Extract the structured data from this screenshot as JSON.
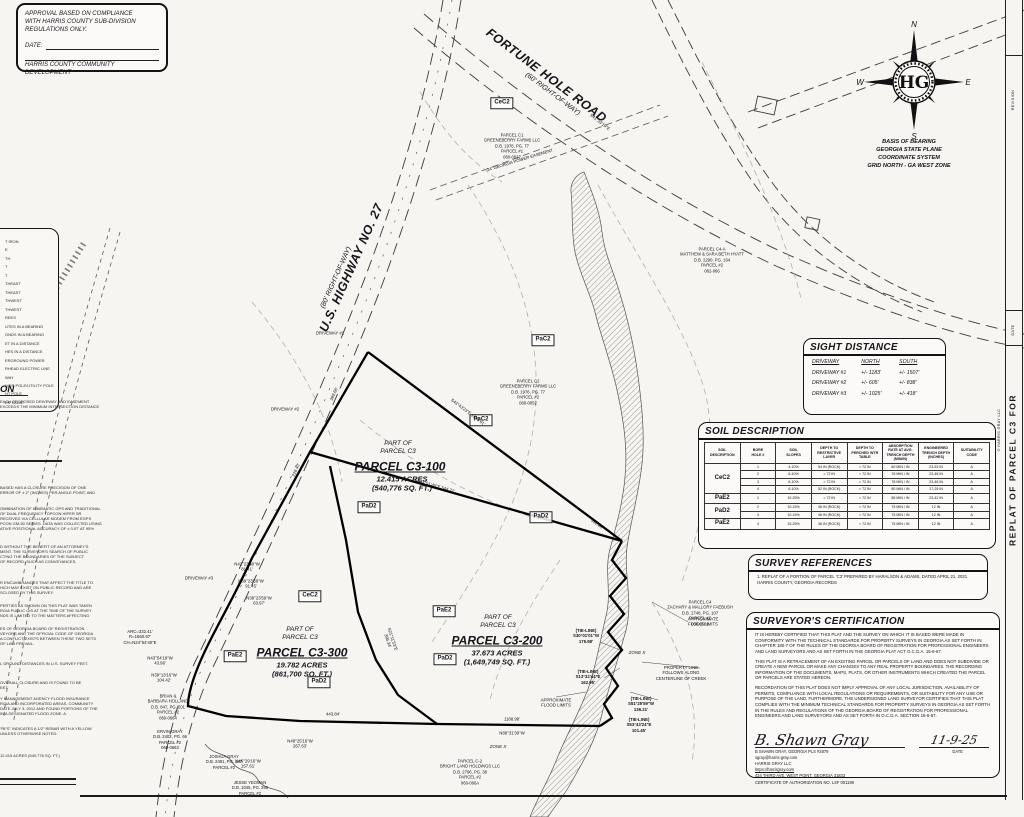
{
  "approval": {
    "line1": "APPROVAL BASED ON COMPLIANCE",
    "line2": "WITH HARRIS COUNTY SUB-DIVISION",
    "line3": "REGULATIONS ONLY.",
    "date_label": "DATE:",
    "agency": "HARRIS COUNTY COMMUNITY DEVELOPMENT"
  },
  "compass": {
    "n": "N",
    "e": "E",
    "s": "S",
    "w": "W",
    "monogram": "HG"
  },
  "basis": {
    "text": "BASIS OF BEARING\nGEORGIA STATE PLANE\nCOORDINATE SYSTEM\nGRID NORTH - GA WEST ZONE"
  },
  "sight_distance": {
    "title": "SIGHT DISTANCE",
    "headers": [
      "DRIVEWAY",
      "NORTH",
      "SOUTH"
    ],
    "rows": [
      [
        "DRIVEWAY #1",
        "+/- 1183'",
        "+/- 1507'"
      ],
      [
        "DRIVEWAY #2",
        "+/- 605'",
        "+/- 838'"
      ],
      [
        "DRIVEWAY #3",
        "+/- 1025'",
        "+/- 418'"
      ]
    ]
  },
  "soil_table": {
    "title": "SOIL DESCRIPTION",
    "headers": [
      "SOIL\nDESCRIPTION",
      "BORE\nHOLE #",
      "SOIL\nSLOPES",
      "DEPTH TO\nRESTRICTIVE\nLAYER",
      "DEPTH TO\nPERCHED WTR\nTABLE",
      "ABSORPTION\nRATE AT AVG.\nTRENCH DEPTH\n(MIN/IN)",
      "ENGINEERED\nTRENCH DEPTH\n(INCHES)",
      "SUITABILITY\nCODE"
    ],
    "groups": [
      {
        "code": "CeC2"
      },
      {
        "code": "PaE2"
      },
      {
        "code": "PaD2"
      },
      {
        "code": "PaE2"
      }
    ],
    "rows": [
      [
        "1",
        "4-10%",
        "54 IN (ROCK)",
        "> 72 IN",
        "80 MIN / IN",
        "23-53 IN",
        "A"
      ],
      [
        "2",
        "6-10%",
        "> 72 IN",
        "> 72 IN",
        "78 MIN / IN",
        "23-48 IN",
        "A"
      ],
      [
        "3",
        "6-10%",
        "> 72 IN",
        "> 72 IN",
        "78 MIN / IN",
        "23-48 IN",
        "A"
      ],
      [
        "4",
        "6-10%",
        "52 IN (ROCK)",
        "> 72 IN",
        "80 MIN / IN",
        "17-25 IN",
        "A"
      ],
      [
        "1",
        "10-25%",
        "> 72 IN",
        "> 72 IN",
        "85 MIN / IN",
        "23-42 IN",
        "A"
      ],
      [
        "2",
        "10-15%",
        "36 IN (ROCK)",
        "> 72 IN",
        "75 MIN / IN",
        "12 IN",
        "A"
      ],
      [
        "3",
        "10-15%",
        "36 IN (ROCK)",
        "> 72 IN",
        "75 MIN / IN",
        "12 IN",
        "A"
      ],
      [
        "4",
        "15-25%",
        "36 IN (ROCK)",
        "> 72 IN",
        "75 MIN / IN",
        "12 IN",
        "A"
      ]
    ]
  },
  "survey_references": {
    "title": "SURVEY REFERENCES",
    "item": "1.   REPLAT OF A PORTION OF PARCEL 'C3' PREPARED BY HARALSON & ADAMS, DATED APRIL 21, 2021 HARRIS COUNTY, GEORGIA RECORDS"
  },
  "cert": {
    "title": "SURVEYOR'S CERTIFICATION",
    "p1": "IT IS HEREBY CERTIFIED THAT THIS PLAT AND THE SURVEY ON WHICH IT IS BASED WERE MADE IN CONFORMITY WITH THE TECHNICAL STANDARDS FOR PROPERTY SURVEYS IN GEORGIA AS SET FORTH IN CHAPTER 180-7 OF THE RULES OF THE GEORGIA BOARD OF REGISTRATION FOR PROFESSIONAL ENGINEERS AND LAND SURVEYORS AND AS SET FORTH IN THE GEORGIA PLAT ACT O.C.G.A. 15-6-67.",
    "p2": "THIS PLAT IS A RETRACEMENT OF AN EXISTING PARCEL OR PARCELS OF LAND AND DOES NOT SUBDIVIDE OR CREATE A NEW PARCEL OR MAKE ANY CHANGES TO ANY REAL PROPERTY BOUNDARIES. THE RECORDING INFORMATION OF THE DOCUMENTS, MAPS, PLATS, OR OTHER INSTRUMENTS WHICH CREATED THE PARCEL OR PARCELS ARE STATED HEREON.",
    "p3": "RECORDATION OF THIS PLAT DOES NOT IMPLY APPROVAL OF ANY LOCAL JURISDICTION, AVAILABILITY OF PERMITS, COMPLIANCE WITH LOCAL REGULATIONS OR REQUIREMENTS, OR SUITABILITY FOR ANY USE OR PURPOSE OF THE LAND. FURTHERMORE, THE UNDERSIGNED LAND SURVEYOR CERTIFIES THAT THIS PLAT COMPLIES WITH THE MINIMUM TECHNICAL STANDARDS FOR PROPERTY SURVEYS IN GEORGIA AS SET FORTH IN THE RULES AND REGULATIONS OF THE GEORGIA BOARD OF REGISTRATION FOR PROFESSIONAL ENGINEERS AND LAND SURVEYORS AND AS SET FORTH IN O.C.G.A. SECTION 15-6-67.",
    "sig_script": "B. Shawn Gray",
    "name_line": "B SHAWN GRAY,  GEORGIA PLS #2879",
    "date_script": "11-9-25",
    "date_label": "DATE",
    "email": "sgray@harris-gray.com",
    "firm": "HARRIS GRAY LLC",
    "url": "https://harrisgray.com",
    "addr": "424 THIRD AVE, WEST POINT, GEORGIA 31833",
    "cert_no": "CERTIFICATE OF AUTHORIZATION NO. LSF 001199"
  },
  "left_margin": {
    "legend": [
      "T IRON",
      "E",
      "TH",
      "T",
      "T",
      "THEAST",
      "THEAST",
      "THWEST",
      "THWEST",
      "REES",
      "UTES IN A BEARING",
      "ONDS IN A BEARING",
      "ET IN A DISTANCE",
      "HES IN A DISTANCE",
      "ERGROUND POWER",
      "RHEAD ELECTRIC LINE",
      "WAY",
      "WER POLE/UTILITY POLE",
      "HT POLE",
      "ER VALVE"
    ],
    "driveway_header": "ON",
    "a": [
      "EACH PROPOSED DRIVEWAY AND EASEMENT",
      "EXCEEDS THE MINIMUM INTERSECTION DISTANCE"
    ],
    "b": [
      "BASED HAS A CLOSURE PRECISION OF ONE",
      "ERROR OF ± 2\" (INCHES) PER ANGLE POINT, AND"
    ],
    "c": [
      "OMBINATION OF KINEMATIC GPS AND TRADITIONAL",
      "OF DUAL FREQUENCY TOPCON HIPER SR",
      "RECEIVED VIA CELLULAR MODEM FROM EGPS",
      "PCON GM-50 SERIES. DATA WAS COLLECTED USING",
      "ATIVE POSITIONAL ACCURACY OF ± 0.07' AT 95%"
    ],
    "d": [
      "D WITHOUT THE BENEFIT OF AN ATTORNEY'S",
      "MENT. THE SURVEYOR'S SEARCH OF PUBLIC",
      "CTING THE BOUNDARIES OF THE SUBJECT",
      "OF RECORD, SUCH AS CONVEYANCES,"
    ],
    "e": [
      "R ENCUMBRANCES THAT AFFECT THE TITLE TO",
      "HICH MAY EXIST ON PUBLIC RECORD AND ARE",
      "SCLOSED BY THIS SURVEY."
    ],
    "f": [
      "PERTIES AS SHOWN ON THIS PLAT WAS TAKEN",
      "RGIA PUBLIC GIS AT THE TIME OF THE SURVEY",
      "NDS IS LIMITED TO THE MATTERS AFFECTING"
    ],
    "g": [
      "ES OF GEORGIA BOARD OF REGISTRATION",
      "VEYORS AND THE OFFICIAL CODE OF GEORGIA",
      "A CONFLICT EXISTS BETWEEN THESE TWO SETS",
      "OF LAW PREVAIL."
    ],
    "h": [
      "L GROUND DISTANCES IN U.S. SURVEY FEET."
    ],
    "i": [
      "OVERALL CLOSURE AND IS FOUND TO BE",
      "EET."
    ],
    "j": [
      "Y MANAGEMENT AGENCY FLOOD INSURANCE",
      "RGIA AND INCORPORATED AREAS, COMMUNITY",
      "DATE JULY 3, 2012 AND FOUND PORTIONS OF THE",
      "IN A DESIGNATED FLOOD ZONE. A"
    ],
    "k": [
      "\"RFS\" INDICATES A 1/2\" REBAR WITH A YELLOW",
      "UNLESS OTHERWISE NOTED."
    ],
    "l": [
      "12.415 ACRES (540,776 SQ. FT.)"
    ]
  },
  "map": {
    "labels": [
      {
        "t": "FORTUNE HOLE ROAD",
        "x": 546,
        "y": 76,
        "r": 37,
        "c": "rd"
      },
      {
        "t": "(60' RIGHT-OF-WAY)",
        "x": 552,
        "y": 95,
        "r": 37,
        "c": "rd2"
      },
      {
        "t": "U.S. HIGHWAY NO. 27",
        "x": 352,
        "y": 268,
        "r": -66,
        "c": "rd"
      },
      {
        "t": "(80' RIGHT-OF-WAY)",
        "x": 337,
        "y": 278,
        "r": -66,
        "c": "rd2"
      },
      {
        "t": "PART OF\nPARCEL C3",
        "x": 398,
        "y": 448,
        "r": 0,
        "c": "pio"
      },
      {
        "t": "PARCEL C3-100",
        "x": 400,
        "y": 467,
        "r": 0,
        "c": "pname"
      },
      {
        "t": "12.415 ACRES\n(540,776 SQ. FT.)",
        "x": 402,
        "y": 484,
        "r": 0,
        "c": "parea"
      },
      {
        "t": "PART OF\nPARCEL C3",
        "x": 300,
        "y": 634,
        "r": 0,
        "c": "pio"
      },
      {
        "t": "PARCEL C3-300",
        "x": 302,
        "y": 653,
        "r": 0,
        "c": "pname"
      },
      {
        "t": "19.782 ACRES\n(861,700 SQ. FT.)",
        "x": 302,
        "y": 670,
        "r": 0,
        "c": "parea"
      },
      {
        "t": "PART OF\nPARCEL C3",
        "x": 498,
        "y": 622,
        "r": 0,
        "c": "pio"
      },
      {
        "t": "PARCEL C3-200",
        "x": 497,
        "y": 641,
        "r": 0,
        "c": "pname"
      },
      {
        "t": "37.673 ACRES\n(1,649,749 SQ. FT.)",
        "x": 497,
        "y": 658,
        "r": 0,
        "c": "parea"
      },
      {
        "t": "PARCEL C1\nGREENEBERRY FARMS LLC\nD.B. 1976, PG. 77\nPARCEL #1\n060-0027",
        "x": 512,
        "y": 146,
        "r": 0,
        "c": "own"
      },
      {
        "t": "PARCEL C2\nGREENEBERRY FARMS LLC\nD.B. 1976, PG. 77\nPARCEL #2\n060-0052",
        "x": 528,
        "y": 392,
        "r": 0,
        "c": "own"
      },
      {
        "t": "PARCEL C4-A\nMATTHEW & SARA BETH HYATT\nD.B. 2290, PG. 164\nPARCEL #2\n062-066",
        "x": 712,
        "y": 260,
        "r": 0,
        "c": "own"
      },
      {
        "t": "PARCEL C4\nZACHARY & MALLORY FAEBUSH\nD.B. 2748, PG. 107\nPARCEL #2\n060-0561",
        "x": 700,
        "y": 613,
        "r": 0,
        "c": "own"
      },
      {
        "t": "PARCEL C-2\nBRIGHT LAND HOLDINGS LLC\nD.B. 2796, PG. 38\nPARCEL #2\n060-066A",
        "x": 470,
        "y": 772,
        "r": 0,
        "c": "own"
      },
      {
        "t": "BRIAN &\nBARBARA HOLLAND\nD.B. 847, PG. 201\nPARCEL #2\n060-0664",
        "x": 168,
        "y": 707,
        "r": 0,
        "c": "own"
      },
      {
        "t": "ERVIN GRAY\nD.B. 2402, PG. 66\nPARCEL #2\n060-0663",
        "x": 170,
        "y": 740,
        "r": 0,
        "c": "own"
      },
      {
        "t": "JOSHUA GRAY\nD.B. 2491, PG. 187\nPARCEL #2",
        "x": 224,
        "y": 762,
        "r": 0,
        "c": "own"
      },
      {
        "t": "JESSE YEOMAN\nD.B. 1045, PG. 295\nPARCEL #2",
        "x": 250,
        "y": 788,
        "r": 0,
        "c": "own"
      },
      {
        "t": "CeC2",
        "x": 502,
        "y": 103,
        "r": 0,
        "c": "soil"
      },
      {
        "t": "PaC2",
        "x": 543,
        "y": 340,
        "r": 0,
        "c": "soil"
      },
      {
        "t": "PaC2",
        "x": 481,
        "y": 420,
        "r": 0,
        "c": "soil"
      },
      {
        "t": "PaD2",
        "x": 369,
        "y": 507,
        "r": 0,
        "c": "soil"
      },
      {
        "t": "PaD2",
        "x": 541,
        "y": 517,
        "r": 0,
        "c": "soil"
      },
      {
        "t": "PaE2",
        "x": 444,
        "y": 611,
        "r": 0,
        "c": "soil"
      },
      {
        "t": "PaD2",
        "x": 445,
        "y": 659,
        "r": 0,
        "c": "soil"
      },
      {
        "t": "CeC2",
        "x": 310,
        "y": 596,
        "r": 0,
        "c": "soil"
      },
      {
        "t": "PaE2",
        "x": 235,
        "y": 656,
        "r": 0,
        "c": "soil"
      },
      {
        "t": "PaD2",
        "x": 319,
        "y": 682,
        "r": 0,
        "c": "soil"
      },
      {
        "t": "S43°43'23\"E  1398.81'",
        "x": 468,
        "y": 412,
        "r": 37,
        "c": "bear"
      },
      {
        "t": "532.46'",
        "x": 597,
        "y": 524,
        "r": 37,
        "c": "bear"
      },
      {
        "t": "S44°51'45\"E  544.21'",
        "x": 436,
        "y": 486,
        "r": 16,
        "c": "bear"
      },
      {
        "t": "S21°11'53\"E\n396.34'",
        "x": 390,
        "y": 640,
        "r": 72,
        "c": "bear"
      },
      {
        "t": "1188.98'",
        "x": 512,
        "y": 719,
        "r": 0,
        "c": "bear"
      },
      {
        "t": "N89°31'30\"W",
        "x": 512,
        "y": 733,
        "r": 0,
        "c": "bear"
      },
      {
        "t": "443.84'",
        "x": 333,
        "y": 714,
        "r": 0,
        "c": "bear"
      },
      {
        "t": "N48°25'16\"W\n267.63'",
        "x": 300,
        "y": 744,
        "r": 0,
        "c": "bear"
      },
      {
        "t": "N46°29'16\"W\n157.61'",
        "x": 248,
        "y": 764,
        "r": 0,
        "c": "bear"
      },
      {
        "t": "N42°23'10\"W\n81.41'",
        "x": 247,
        "y": 567,
        "r": 0,
        "c": "bear"
      },
      {
        "t": "N39°23'59\"W\n91.45'",
        "x": 251,
        "y": 584,
        "r": 0,
        "c": "bear"
      },
      {
        "t": "N39°23'59\"W\n63.97'",
        "x": 259,
        "y": 601,
        "r": 0,
        "c": "bear"
      },
      {
        "t": "ARC=332.41'\nR=1660.97'\nCH=N24°54'40\"E",
        "x": 140,
        "y": 637,
        "r": 0,
        "c": "bear"
      },
      {
        "t": "N43°54'19\"W\n43.96'",
        "x": 160,
        "y": 661,
        "r": 0,
        "c": "bear"
      },
      {
        "t": "N39°13'16\"W\n104.42'",
        "x": 164,
        "y": 678,
        "r": 0,
        "c": "bear"
      },
      {
        "t": "(TIE-LINE)\nS30°01'01\"W\n175.98'",
        "x": 586,
        "y": 636,
        "r": 0,
        "c": "bear bd"
      },
      {
        "t": "(TIE-LINE)\nS13°32'44\"E\n162.95'",
        "x": 588,
        "y": 677,
        "r": 0,
        "c": "bear bd"
      },
      {
        "t": "(TIE-LINE)\nS51°25'59\"W\n136.21'",
        "x": 641,
        "y": 704,
        "r": 0,
        "c": "bear bd"
      },
      {
        "t": "(TIE-LINE)\nS53°43'24\"E\n101.45'",
        "x": 639,
        "y": 725,
        "r": 0,
        "c": "bear bd"
      },
      {
        "t": "DRIVEWAY #1",
        "x": 330,
        "y": 333,
        "r": 0,
        "c": "tinyl"
      },
      {
        "t": "DRIVEWAY #2",
        "x": 285,
        "y": 409,
        "r": 0,
        "c": "tinyl"
      },
      {
        "t": "DRIVEWAY #3",
        "x": 199,
        "y": 578,
        "r": 0,
        "c": "tinyl"
      },
      {
        "t": "24' GEORGIA POWER EASEMENT",
        "x": 520,
        "y": 160,
        "r": -17,
        "c": "tinyl"
      },
      {
        "t": "S41°33'19\"E",
        "x": 600,
        "y": 122,
        "r": 38,
        "c": "bear"
      },
      {
        "t": "399.66'",
        "x": 334,
        "y": 394,
        "r": -66,
        "c": "bear"
      },
      {
        "t": "228.43'",
        "x": 296,
        "y": 470,
        "r": -66,
        "c": "bear"
      },
      {
        "t": "ZONE X",
        "x": 637,
        "y": 653,
        "r": 0,
        "c": "zone"
      },
      {
        "t": "ZONE X",
        "x": 498,
        "y": 747,
        "r": 0,
        "c": "zone"
      },
      {
        "t": "APPROXIMATE\nFLOOD LIMITS",
        "x": 556,
        "y": 703,
        "r": 0,
        "c": "tinyl"
      },
      {
        "t": "APPROXIMATE\nFLOOD LIMITS",
        "x": 703,
        "y": 622,
        "r": 0,
        "c": "tinyl"
      },
      {
        "t": "PROPERTY LINE\nFOLLOWS ALONG\nCENTERLINE OF CREEK",
        "x": 681,
        "y": 673,
        "r": 0,
        "c": "tinyl"
      },
      {
        "t": "REPLAT OF PARCEL C3 FOR",
        "x": 1013,
        "y": 470,
        "r": -90,
        "c": "vtitle"
      },
      {
        "t": "REVISION",
        "x": 1013,
        "y": 100,
        "r": -90,
        "c": "vtiny"
      },
      {
        "t": "DATE",
        "x": 1013,
        "y": 330,
        "r": -90,
        "c": "vtiny"
      },
      {
        "t": "© HARRIS GRAY LLC",
        "x": 999,
        "y": 430,
        "r": -90,
        "c": "vtiny"
      }
    ]
  }
}
